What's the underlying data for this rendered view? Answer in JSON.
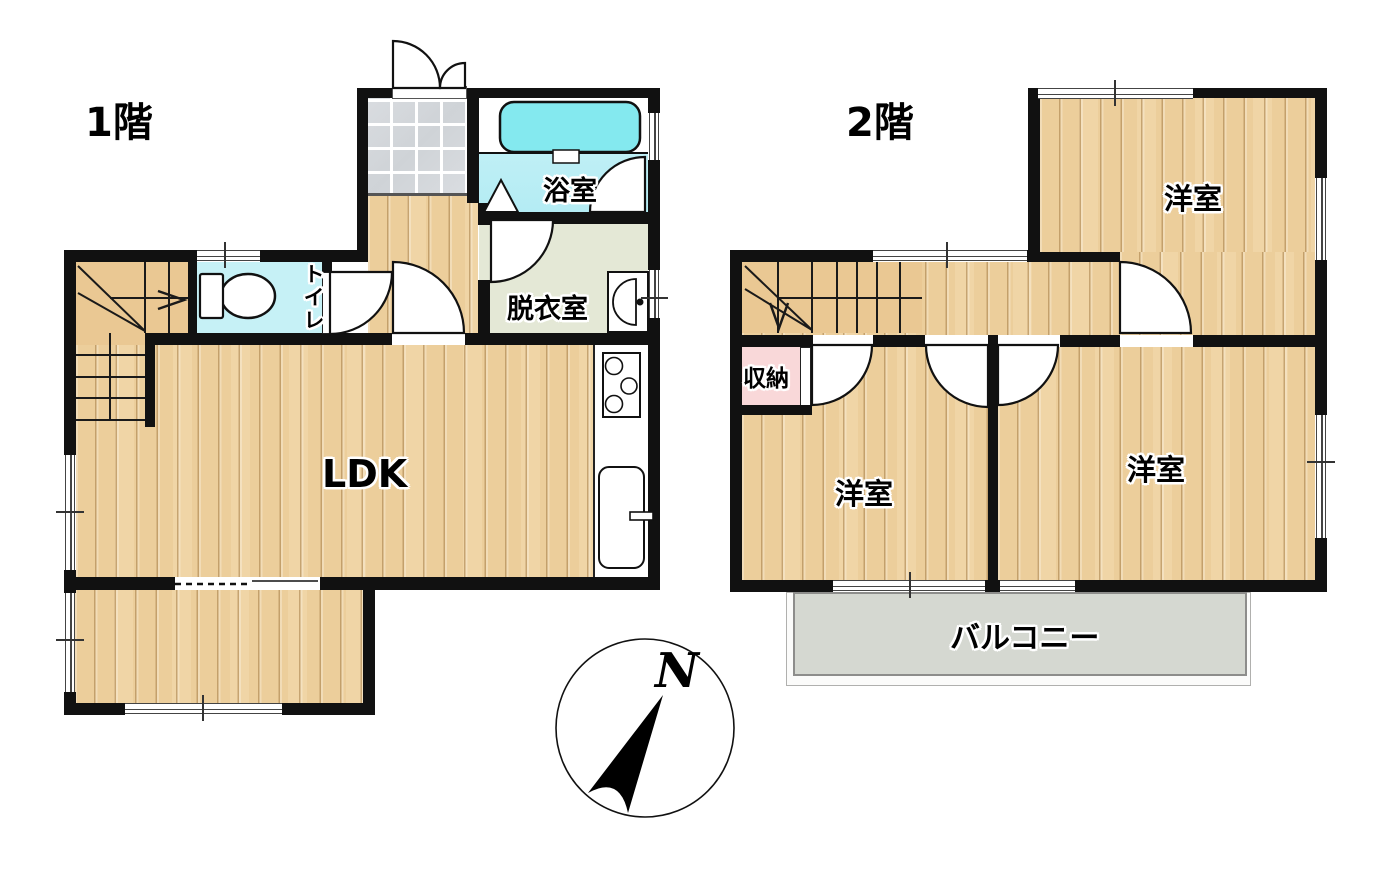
{
  "floor1": {
    "label": "1階",
    "rooms": {
      "ldk": "LDK",
      "bath": "浴室",
      "dressing": "脱衣室",
      "toilet": "トイレ"
    }
  },
  "floor2": {
    "label": "2階",
    "rooms": {
      "western_top": "洋室",
      "western_left": "洋室",
      "western_right": "洋室",
      "closet": "収納",
      "balcony": "バルコニー"
    }
  },
  "compass": {
    "north": "N"
  },
  "colors": {
    "wall": "#111111",
    "wood_floor": "#f0d5a6",
    "stair": "#eac893",
    "entrance_tile": "#d4d7da",
    "bath_floor": "#bceef5",
    "bathtub": "#84e9ef",
    "toilet_floor": "#c6f1f6",
    "dressing_floor": "#e4e8d6",
    "closet": "#f9d8d9",
    "balcony": "#d5d8d1"
  }
}
